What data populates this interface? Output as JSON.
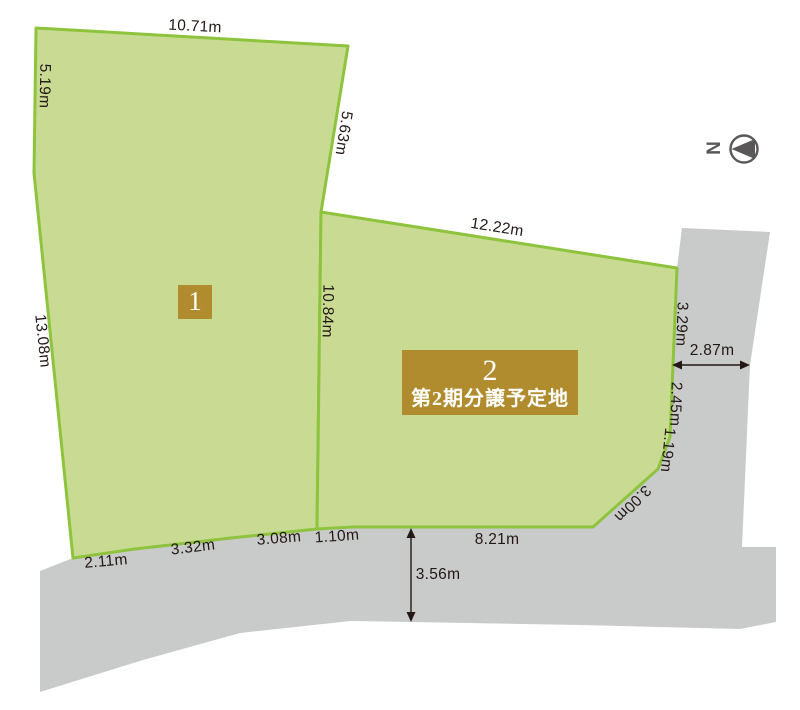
{
  "diagram": {
    "type": "land-subdivision-plot-plan",
    "colors": {
      "plot_fill": "#c9db93",
      "plot_stroke": "#8dc33d",
      "road_fill": "#c9caca",
      "badge_background": "#b08c2e",
      "badge_text": "#ffffff",
      "dimension_text": "#231815",
      "compass": "#595757",
      "background": "#ffffff"
    },
    "plots": [
      {
        "number": "1",
        "note": ""
      },
      {
        "number": "2",
        "note": "第2期分譲予定地"
      }
    ],
    "compass": {
      "label": "N",
      "direction": "pointing-left"
    },
    "measurements": {
      "plot1_top": "10.71m",
      "plot1_left_upper": "5.19m",
      "plot1_left_lower": "13.08m",
      "plot1_right": "5.63m",
      "plot2_top": "12.22m",
      "divider": "10.84m",
      "plot2_right_upper": "3.29m",
      "road_right_width": "2.87m",
      "plot2_right_mid": "2.45m",
      "plot2_right_lower": "1.19m",
      "plot2_corner_cut": "3.00m",
      "plot2_bottom": "8.21m",
      "road_bottom_width": "3.56m",
      "bottom_seg_1_10": "1.10m",
      "bottom_seg_3_08": "3.08m",
      "bottom_seg_3_32": "3.32m",
      "bottom_seg_2_11": "2.11m"
    }
  }
}
